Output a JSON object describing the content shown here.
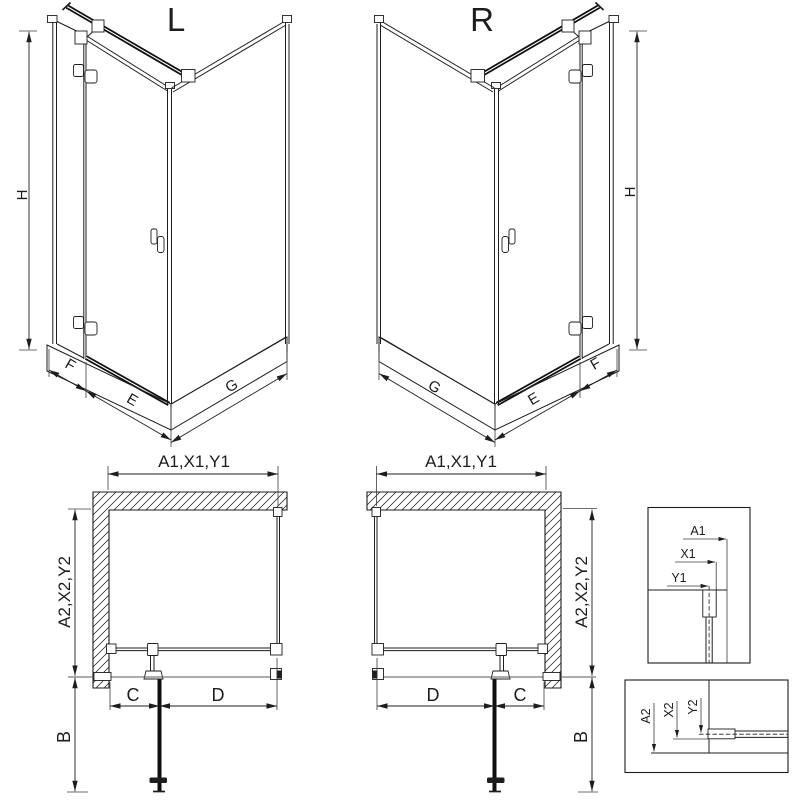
{
  "colors": {
    "line": "#1d1d1b",
    "background": "#ffffff"
  },
  "views": {
    "iso_left": {
      "label": "L",
      "dim_height": "H",
      "dim_fixed": "F",
      "dim_door": "E",
      "dim_side": "G"
    },
    "iso_right": {
      "label": "R",
      "dim_height": "H",
      "dim_fixed": "F",
      "dim_door": "E",
      "dim_side": "G"
    },
    "plan_left": {
      "dim_top": "A1,X1,Y1",
      "dim_side": "A2,X2,Y2",
      "dim_fixed": "C",
      "dim_door": "D",
      "dim_open": "B"
    },
    "plan_right": {
      "dim_top": "A1,X1,Y1",
      "dim_side": "A2,X2,Y2",
      "dim_fixed": "C",
      "dim_door": "D",
      "dim_open": "B"
    },
    "detail_horizontal": {
      "dim_a": "A1",
      "dim_x": "X1",
      "dim_y": "Y1"
    },
    "detail_vertical": {
      "dim_a": "A2",
      "dim_x": "X2",
      "dim_y": "Y2"
    }
  }
}
